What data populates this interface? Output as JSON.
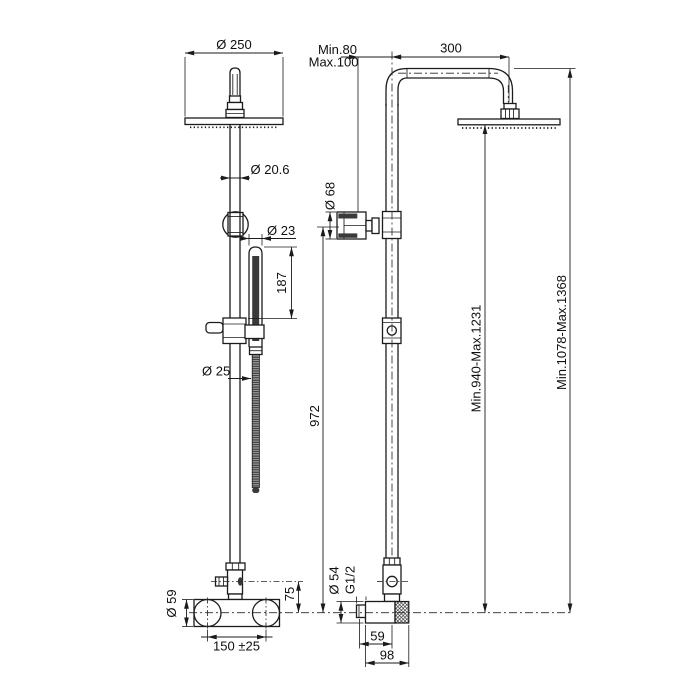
{
  "drawing_type": "shower-column-technical-drawing",
  "colors": {
    "line": "#1c1c1c",
    "background": "#ffffff"
  },
  "front_view": {
    "head_diameter": "Ø 250",
    "riser_diameter": "Ø 20.6",
    "handshower_diameter": "Ø 23",
    "handshower_length": "187",
    "hose_diameter": "Ø 25",
    "union_diameter": "Ø 59",
    "diverter_offset": "75",
    "union_spacing": "150 ±25"
  },
  "side_view": {
    "wall_distance_min": "Min.80",
    "wall_distance_max": "Max.100",
    "arm_reach": "300",
    "handshower_head_diameter": "Ø 68",
    "riser_length": "972",
    "head_height_range": "Min.940-Max.1231",
    "total_height_range": "Min.1078-Max.1368",
    "valve_body_diameter": "Ø 54",
    "connection_thread": "G1/2",
    "wall_to_axis_depth": "59",
    "total_depth": "98"
  }
}
